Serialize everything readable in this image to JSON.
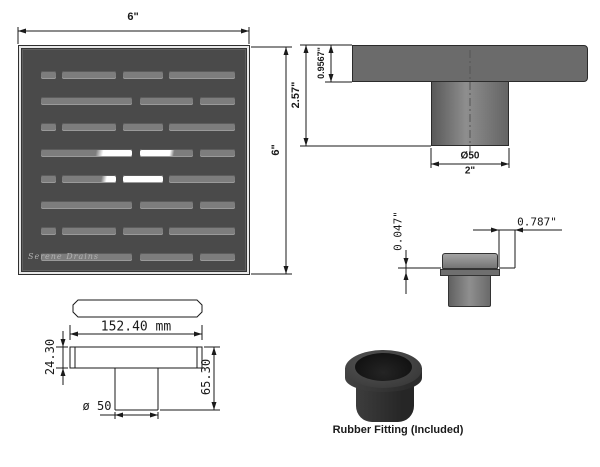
{
  "branding": {
    "logo": "Serene Drains"
  },
  "dims": {
    "top_view": {
      "width": "6\"",
      "height": "6\""
    },
    "side_view": {
      "total_height": "2.57\"",
      "top_thickness": "0.9567\"",
      "outlet_diameter": "Ø50",
      "outlet_width": "2\""
    },
    "detail_view": {
      "lip_height": "0.047\"",
      "edge_offset": "0.787\""
    },
    "bottom_view": {
      "width": "152.40 mm",
      "flange_height": "24.30",
      "total_height": "65.30",
      "outlet_diameter": "ø 50"
    }
  },
  "rubber_fitting": {
    "caption": "Rubber Fitting (Included)"
  },
  "colors": {
    "grate_body": "#4a4a4a",
    "grate_slot": "#7d7d7d",
    "slot_highlight": "#ffffff",
    "slab_gray": "#6b6b6b",
    "line": "#1a1a1a",
    "fitting_rubber": "#2f2f2f"
  },
  "grate": {
    "rows": [
      {
        "top": 22,
        "slots": [
          {
            "w": 15,
            "f": "gray"
          },
          {
            "w": 54,
            "f": "gray"
          },
          {
            "w": 40,
            "f": "gray"
          },
          {
            "w": 66,
            "f": "gray"
          }
        ]
      },
      {
        "top": 48,
        "slots": [
          {
            "w": 91,
            "f": "gray"
          },
          {
            "w": 53,
            "f": "gray"
          },
          {
            "w": 35,
            "f": "gray"
          }
        ]
      },
      {
        "top": 74,
        "slots": [
          {
            "w": 15,
            "f": "gray"
          },
          {
            "w": 54,
            "f": "gray"
          },
          {
            "w": 40,
            "f": "gray"
          },
          {
            "w": 66,
            "f": "gray"
          }
        ]
      },
      {
        "top": 100,
        "slots": [
          {
            "w": 91,
            "f": "gray-white"
          },
          {
            "w": 53,
            "f": "white-gray"
          },
          {
            "w": 35,
            "f": "gray"
          }
        ]
      },
      {
        "top": 126,
        "slots": [
          {
            "w": 15,
            "f": "gray"
          },
          {
            "w": 54,
            "f": "gray-whiteend"
          },
          {
            "w": 40,
            "f": "white"
          },
          {
            "w": 66,
            "f": "gray"
          }
        ]
      },
      {
        "top": 152,
        "slots": [
          {
            "w": 91,
            "f": "gray"
          },
          {
            "w": 53,
            "f": "gray"
          },
          {
            "w": 35,
            "f": "gray"
          }
        ]
      },
      {
        "top": 178,
        "slots": [
          {
            "w": 15,
            "f": "gray"
          },
          {
            "w": 54,
            "f": "gray"
          },
          {
            "w": 40,
            "f": "gray"
          },
          {
            "w": 66,
            "f": "gray"
          }
        ]
      },
      {
        "top": 204,
        "slots": [
          {
            "w": 91,
            "f": "gray"
          },
          {
            "w": 53,
            "f": "gray"
          },
          {
            "w": 35,
            "f": "gray"
          }
        ]
      }
    ]
  }
}
